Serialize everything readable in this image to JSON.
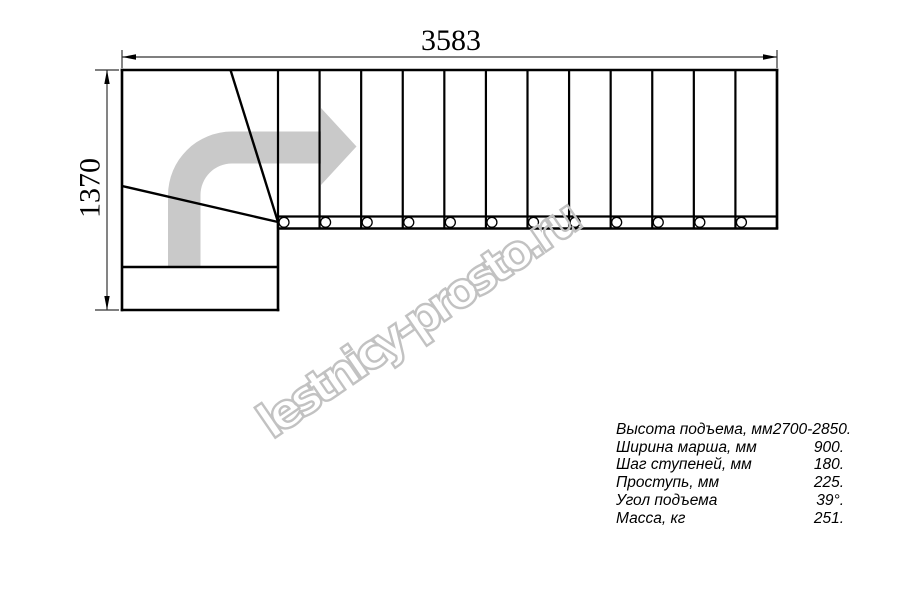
{
  "drawing": {
    "top_dimension": "3583",
    "left_dimension": "1370",
    "flight": {
      "treads": 12
    },
    "line_color": "#000000",
    "arrow_color": "#c9c9c9"
  },
  "watermark": {
    "text": "lestnicy-prosto.ru",
    "color": "#c2c2c2"
  },
  "specs": {
    "rows": [
      {
        "label": "Высота подъема, мм",
        "value": "2700-2850."
      },
      {
        "label": "Ширина марша, мм",
        "value": "900."
      },
      {
        "label": "Шаг ступеней, мм",
        "value": "180."
      },
      {
        "label": "Проступь, мм",
        "value": "225."
      },
      {
        "label": "Угол подъема",
        "value": "39°."
      },
      {
        "label": "Масса, кг",
        "value": "251."
      }
    ]
  }
}
